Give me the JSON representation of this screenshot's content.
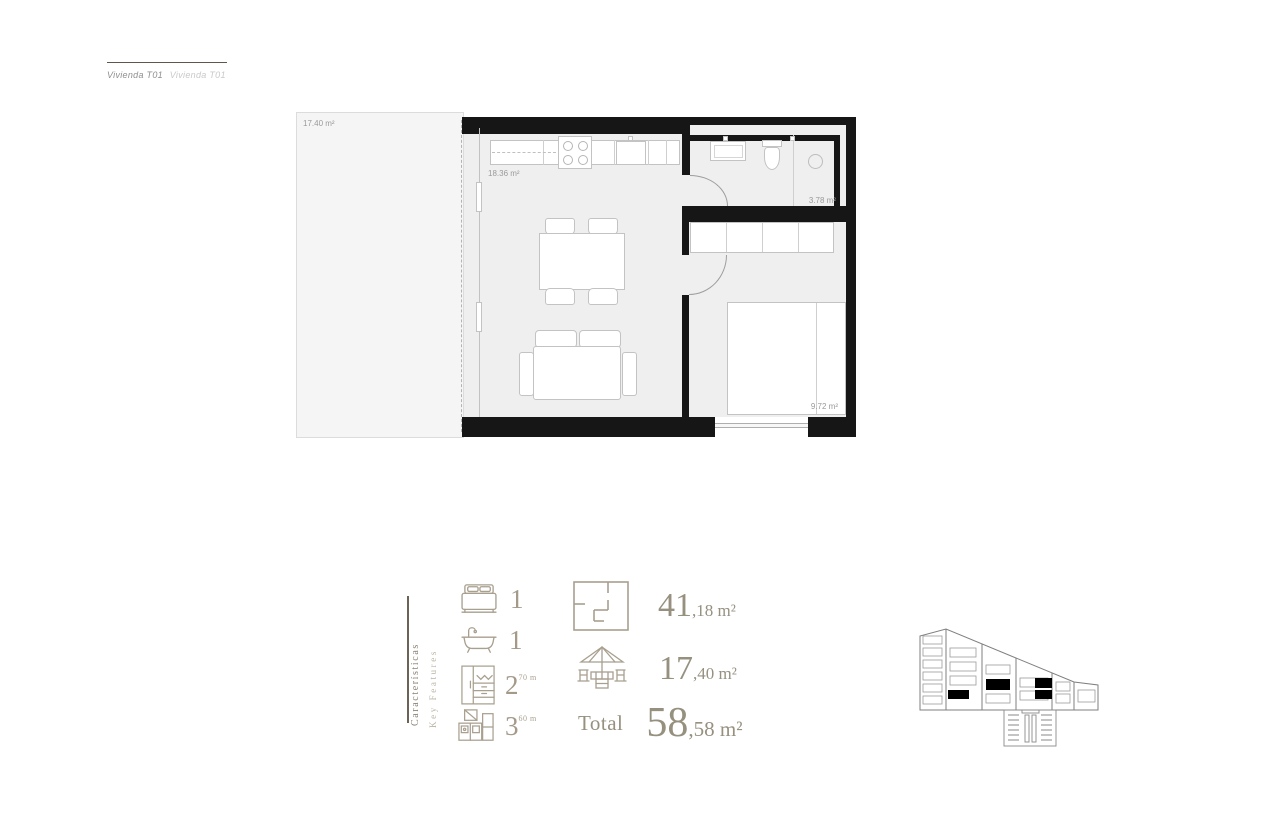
{
  "header": {
    "title_primary": "Vivienda T01",
    "title_secondary": "Vivienda T01"
  },
  "floor_plan": {
    "rooms": [
      {
        "name": "terrace",
        "area_label": "17.40 m²"
      },
      {
        "name": "living-kitchen",
        "area_label": "18.36 m²"
      },
      {
        "name": "bathroom",
        "area_label": "3.78 m²"
      },
      {
        "name": "bedroom",
        "area_label": "9.72 m²"
      }
    ]
  },
  "features": {
    "heading_primary": "Características",
    "heading_secondary": "Key Features",
    "items": [
      {
        "icon": "bed-icon",
        "value": "1",
        "sup": ""
      },
      {
        "icon": "bathtub-icon",
        "value": "1",
        "sup": ""
      },
      {
        "icon": "wardrobe-icon",
        "value": "2",
        "sup": "70 m"
      },
      {
        "icon": "kitchen-icon",
        "value": "3",
        "sup": "60 m"
      }
    ]
  },
  "areas": {
    "interior": {
      "icon": "floorplan-icon",
      "big": "41",
      "small": ",18 m²"
    },
    "terrace": {
      "icon": "terrace-icon",
      "big": "17",
      "small": ",40 m²"
    },
    "total": {
      "label": "Total",
      "big": "58",
      "small": ",58 m²"
    }
  },
  "building_diagram": {
    "name": "unit-location-elevation"
  },
  "colors": {
    "accent_tan": "#a89f8e",
    "feature_text": "#96907f",
    "wall": "#161616",
    "interior_fill": "#efefef",
    "terrace_fill": "#f5f5f5",
    "unit_highlight": "#000000"
  }
}
